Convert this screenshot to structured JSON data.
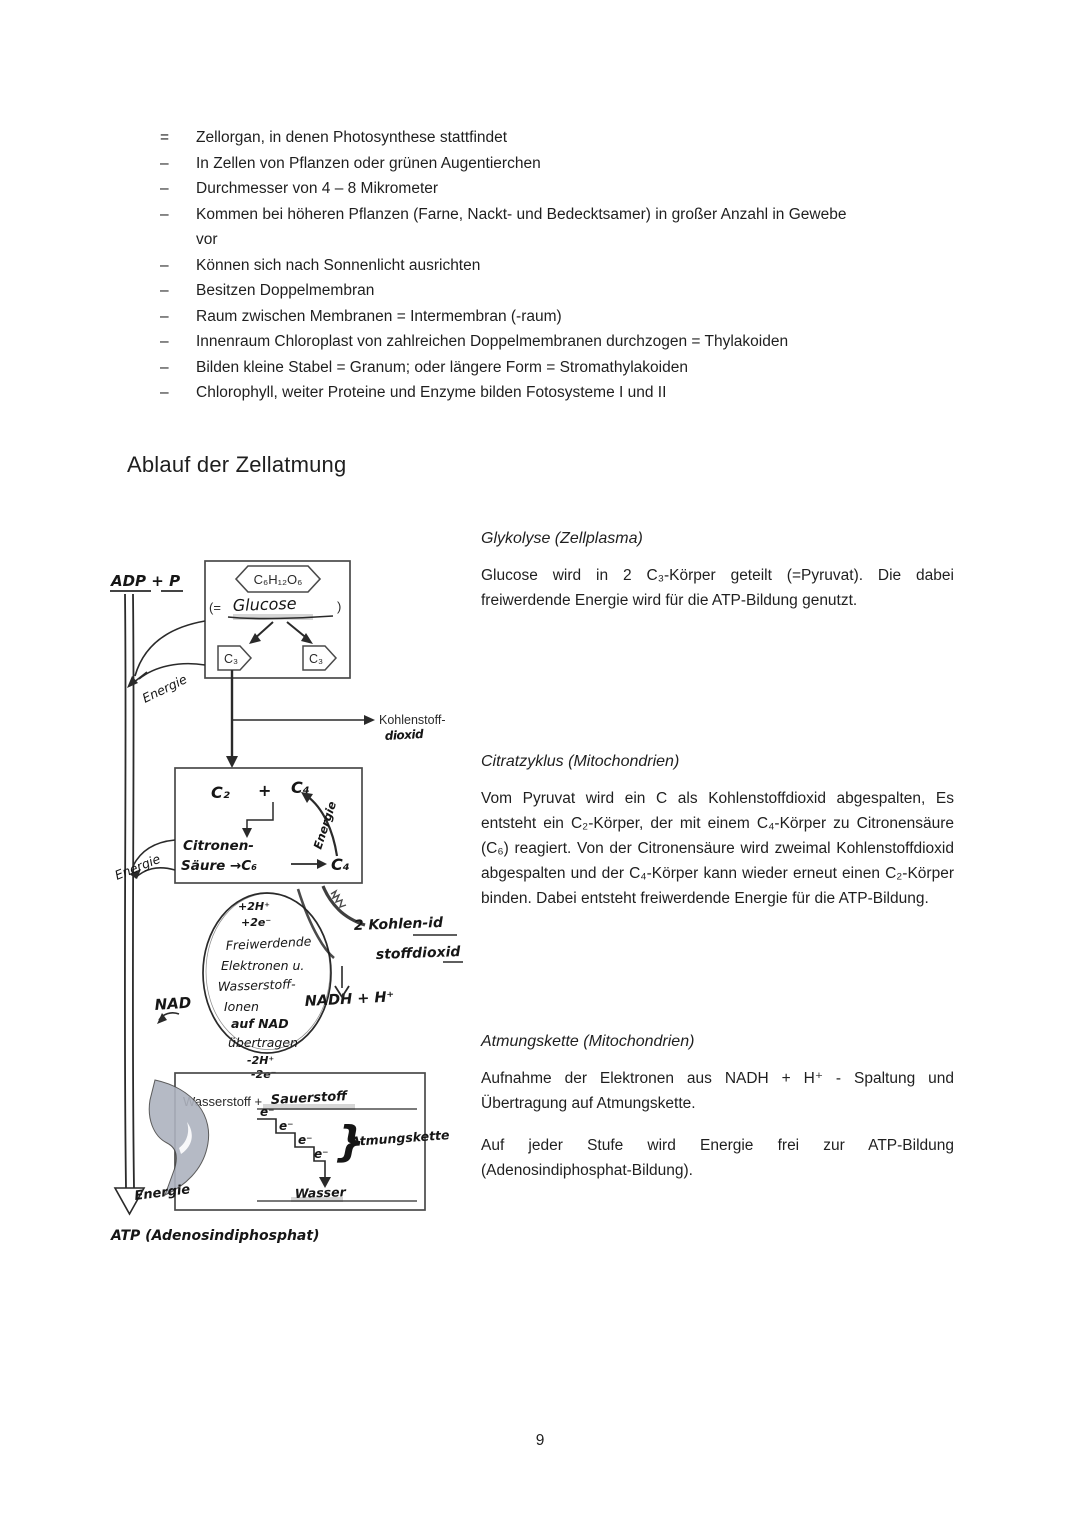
{
  "page": {
    "number": "9"
  },
  "bullets": {
    "items": [
      {
        "marker": "=",
        "line1": "Zellorgan, in denen Photosynthese stattfindet"
      },
      {
        "marker": "–",
        "line1": "In Zellen von Pflanzen oder grünen Augentierchen"
      },
      {
        "marker": "–",
        "line1": "Durchmesser von 4 – 8 Mikrometer"
      },
      {
        "marker": "–",
        "line1": "Kommen bei höheren Pflanzen (Farne, Nackt- und Bedecktsamer) in großer Anzahl in Gewebe",
        "line2": "vor"
      },
      {
        "marker": "–",
        "line1": "Können sich nach Sonnenlicht ausrichten"
      },
      {
        "marker": "–",
        "line1": "Besitzen Doppelmembran"
      },
      {
        "marker": "–",
        "line1": "Raum zwischen Membranen = Intermembran (-raum)"
      },
      {
        "marker": "–",
        "line1": "Innenraum Chloroplast von zahlreichen Doppelmembranen durchzogen = Thylakoiden"
      },
      {
        "marker": "–",
        "line1": "Bilden kleine Stabel = Granum; oder längere Form = Stromathylakoiden"
      },
      {
        "marker": "–",
        "line1": "Chlorophyll, weiter Proteine und Enzyme bilden Fotosysteme I und II"
      }
    ]
  },
  "heading": "Ablauf der Zellatmung",
  "sections": [
    {
      "title": "Glykolyse (Zellplasma)",
      "p1": "Glucose wird in 2 C₃-Körper geteilt (=Pyruvat). Die dabei freiwerdende Energie wird für die ATP-Bildung genutzt."
    },
    {
      "title": "Citratzyklus (Mitochondrien)",
      "p1": "Vom Pyruvat wird ein C als Kohlenstoffdioxid abgespalten, Es entsteht ein C₂-Körper, der mit einem C₄-Körper zu Citronensäure (C₆) reagiert. Von der Citronensäure wird zweimal Kohlenstoffdioxid abgespalten und der C₄-Körper kann wieder erneut einen C₂-Körper binden. Dabei entsteht freiwerdende Energie für die ATP-Bildung."
    },
    {
      "title": "Atmungskette (Mitochondrien)",
      "p1": "Aufnahme der Elektronen aus NADH + H⁺ - Spaltung und Übertragung auf Atmungskette.",
      "p2": "Auf jeder Stufe wird Energie frei zur ATP-Bildung (Adenosindiphosphat-Bildung)."
    }
  ],
  "diagram": {
    "adp_label": "ADP + P",
    "atp_label": "ATP (Adenosindiphosphat)",
    "energie_1": "Energie",
    "energie_2": "Energie",
    "energie_3": "Energie",
    "cycle_label": "Energie",
    "glucose_formula": "C₆H₁₂O₆",
    "glucose_open": "(=",
    "glucose_name": "Glucose",
    "glucose_close": ")",
    "c3_left": "C₃",
    "c3_right": "C₃",
    "kohlenstoff_line1": "Kohlenstoff-",
    "kohlenstoff_line2": "dioxid",
    "citrat_c2": "C₂",
    "citrat_plus": "+",
    "citrat_c4_top": "C₄",
    "citronen_line1": "Citronen-",
    "citronen_line2": "Säure →C₆",
    "citronen_c4": "C₄",
    "plus_2h": "+2H⁺",
    "plus_2e": "+2e⁻",
    "oval_line1": "Freiwerdende",
    "oval_line2": "Elektronen u.",
    "oval_line3": "Wasserstoff-",
    "oval_line4": "Ionen",
    "oval_line5": "auf NAD",
    "oval_line6": "übertragen",
    "oval_line7": "-2H⁺",
    "oval_line8": "-2e⁻",
    "nad": "NAD",
    "nadh": "NADH + H⁺",
    "co2_line1": "2 Kohlen-id",
    "co2_line2": "stoffdioxid",
    "wasserstoff": "Wasserstoff +",
    "sauerstoff": "Sauerstoff",
    "electron": "e⁻",
    "atmungskette": "Atmungskette",
    "wasser": "Wasser"
  }
}
